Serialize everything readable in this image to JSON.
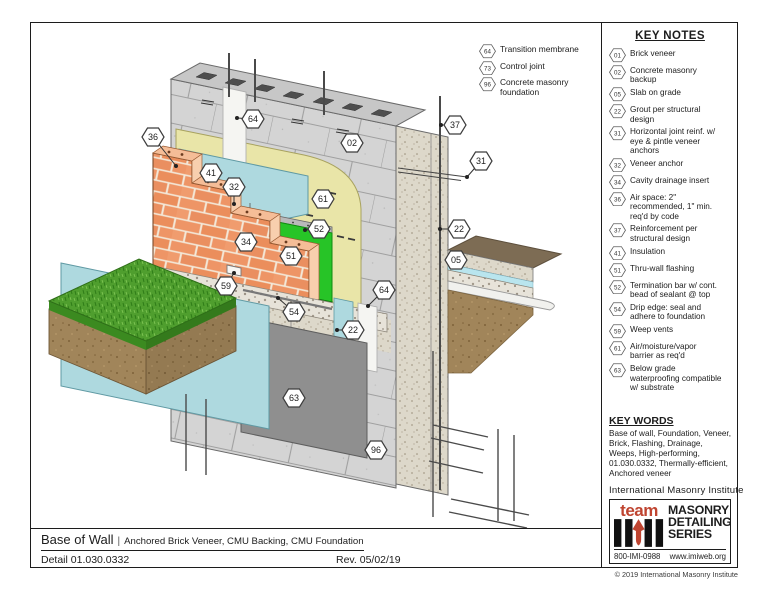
{
  "title_block": {
    "title": "Base of Wall",
    "separator": "|",
    "subtitle": "Anchored Brick Veneer, CMU Backing, CMU Foundation",
    "detail": "Detail 01.030.0332",
    "revision": "Rev. 05/02/19"
  },
  "key_notes": {
    "heading": "KEY NOTES",
    "items": [
      {
        "num": "01",
        "text": "Brick veneer"
      },
      {
        "num": "02",
        "text": "Concrete masonry backup"
      },
      {
        "num": "05",
        "text": "Slab on grade"
      },
      {
        "num": "22",
        "text": "Grout per structural design"
      },
      {
        "num": "31",
        "text": "Horizontal joint reinf. w/ eye & pintle veneer anchors"
      },
      {
        "num": "32",
        "text": "Veneer anchor"
      },
      {
        "num": "34",
        "text": "Cavity drainage insert"
      },
      {
        "num": "36",
        "text": "Air space: 2\" recommended, 1\" min. req'd by code"
      },
      {
        "num": "37",
        "text": "Reinforcement per structural design"
      },
      {
        "num": "41",
        "text": "Insulation"
      },
      {
        "num": "51",
        "text": "Thru-wall flashing"
      },
      {
        "num": "52",
        "text": "Termination bar w/ cont. bead of sealant @ top"
      },
      {
        "num": "54",
        "text": "Drip edge: seal and adhere to foundation"
      },
      {
        "num": "59",
        "text": "Weep vents"
      },
      {
        "num": "61",
        "text": "Air/moisture/vapor barrier as req'd"
      },
      {
        "num": "63",
        "text": "Below grade waterproofing compatible w/ substrate"
      }
    ]
  },
  "legend": {
    "items": [
      {
        "num": "64",
        "text": "Transition membrane"
      },
      {
        "num": "73",
        "text": "Control joint"
      },
      {
        "num": "96",
        "text": "Concrete masonry foundation"
      }
    ]
  },
  "key_words": {
    "heading": "KEY WORDS",
    "text": "Base of wall, Foundation, Veneer, Brick, Flashing, Drainage, Weeps, High-performing, 01.030.0332, Thermally-efficient, Anchored veneer"
  },
  "branding": {
    "institute": "International Masonry Institute",
    "team": "team",
    "series_lines": [
      "MASONRY",
      "DETAILING",
      "SERIES"
    ],
    "phone": "800-IMI-0988",
    "website": "www.imiweb.org",
    "copyright": "© 2019 International Masonry Institute",
    "accent_red": "#bf4430"
  },
  "colors": {
    "cmu": "#d4d4d4",
    "brick": "#ee9566",
    "membrane": "#e9e5a8",
    "insulation": "#aed9df",
    "flashing": "#27c427",
    "flashing_dark": "#12a312",
    "grass": "#4f9e2e",
    "soil": "#a1855a",
    "waterproofing": "#8f8f8f",
    "slab_top": "#7d6c54",
    "vapor_barrier": "#b9e5ee"
  },
  "drawing": {
    "callouts": [
      {
        "num": "36",
        "x": 152,
        "y": 136,
        "tx": 175,
        "ty": 165
      },
      {
        "num": "64",
        "x": 252,
        "y": 118,
        "tx": 236,
        "ty": 117
      },
      {
        "num": "02",
        "x": 351,
        "y": 142
      },
      {
        "num": "37",
        "x": 454,
        "y": 124,
        "tx": 440,
        "ty": 124
      },
      {
        "num": "31",
        "x": 480,
        "y": 160,
        "tx": 466,
        "ty": 176
      },
      {
        "num": "41",
        "x": 210,
        "y": 172
      },
      {
        "num": "32",
        "x": 233,
        "y": 186,
        "tx": 233,
        "ty": 203
      },
      {
        "num": "61",
        "x": 322,
        "y": 198
      },
      {
        "num": "52",
        "x": 318,
        "y": 228,
        "tx": 304,
        "ty": 229
      },
      {
        "num": "22",
        "x": 458,
        "y": 228,
        "tx": 439,
        "ty": 228
      },
      {
        "num": "34",
        "x": 245,
        "y": 241
      },
      {
        "num": "51",
        "x": 290,
        "y": 255
      },
      {
        "num": "05",
        "x": 455,
        "y": 259
      },
      {
        "num": "64",
        "x": 383,
        "y": 289,
        "tx": 367,
        "ty": 305
      },
      {
        "num": "59",
        "x": 225,
        "y": 285,
        "tx": 233,
        "ty": 272
      },
      {
        "num": "54",
        "x": 293,
        "y": 311,
        "tx": 277,
        "ty": 297
      },
      {
        "num": "22",
        "x": 352,
        "y": 329,
        "tx": 336,
        "ty": 329
      },
      {
        "num": "63",
        "x": 293,
        "y": 397
      },
      {
        "num": "96",
        "x": 375,
        "y": 449
      }
    ]
  }
}
